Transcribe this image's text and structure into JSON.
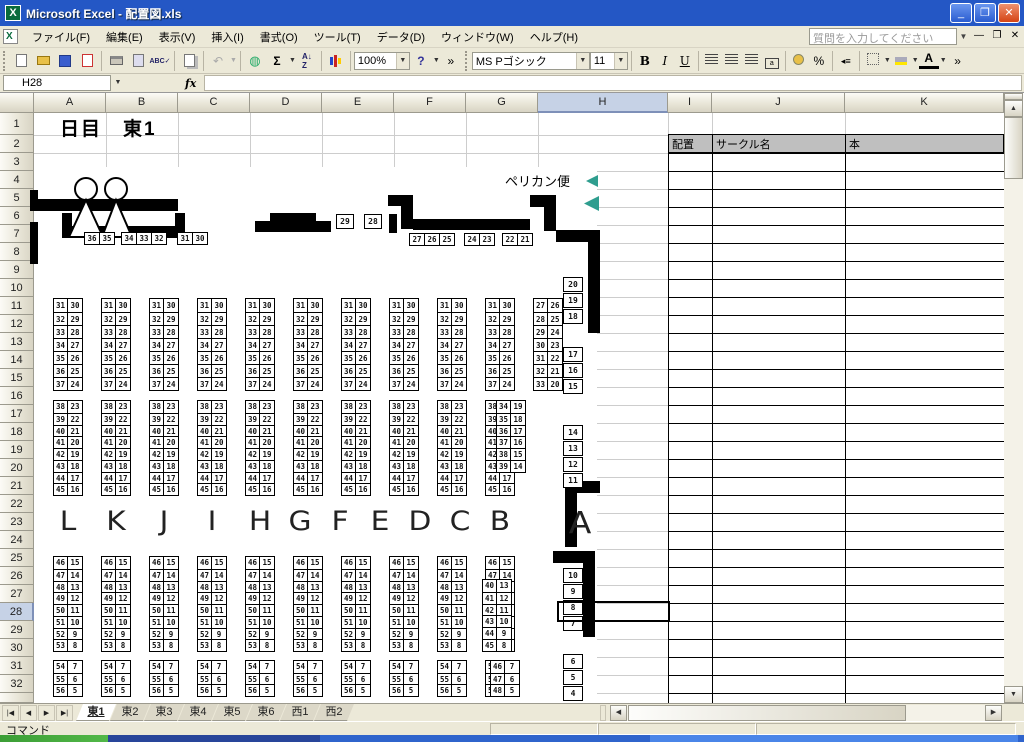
{
  "window": {
    "title": "Microsoft Excel - 配置図.xls"
  },
  "menu": {
    "items": [
      "ファイル(F)",
      "編集(E)",
      "表示(V)",
      "挿入(I)",
      "書式(O)",
      "ツール(T)",
      "データ(D)",
      "ウィンドウ(W)",
      "ヘルプ(H)"
    ],
    "question_placeholder": "質問を入力してください"
  },
  "toolbar": {
    "zoom": "100%",
    "font_name": "MS Pゴシック",
    "font_size": "11",
    "bold": "B",
    "italic": "I",
    "underline": "U",
    "sum": "Σ",
    "sort": "A↓",
    "spelling": "ABC",
    "undo": "↶",
    "help": "?",
    "overflow": "»",
    "percent": "%",
    "font_color": "A"
  },
  "formula_bar": {
    "name_box": "H28",
    "fx_label": "fx",
    "formula": ""
  },
  "grid": {
    "column_labels": [
      "A",
      "B",
      "C",
      "D",
      "E",
      "F",
      "G",
      "H",
      "I",
      "J",
      "K"
    ],
    "row_count": 32,
    "selected_column": "H",
    "selected_row": 28,
    "selected_cell": "H28"
  },
  "sheet": {
    "title": "日目　東1",
    "delivery_label": "ペリカン便",
    "lookup_headers": [
      "配置",
      "サークル名",
      "本"
    ],
    "block_letters": [
      "L",
      "K",
      "J",
      "I",
      "H",
      "G",
      "F",
      "E",
      "D",
      "C",
      "B",
      "A"
    ],
    "wall_numbers": {
      "top_left_groups": [
        [
          "36",
          "35"
        ],
        [
          "34",
          "33",
          "32"
        ],
        [
          "31",
          "30"
        ]
      ],
      "island_boxes": [
        "29",
        "28"
      ],
      "top_right_groups": [
        [
          "27",
          "26",
          "25"
        ],
        [
          "24",
          "23"
        ],
        [
          "22",
          "21"
        ]
      ],
      "right_groups": [
        [
          "20",
          "19",
          "18"
        ],
        [
          "17",
          "16",
          "15"
        ],
        [
          "14",
          "13",
          "12",
          "11"
        ],
        [
          "10",
          "9",
          "8",
          "7"
        ],
        [
          "6",
          "5",
          "4"
        ]
      ]
    },
    "booth_bands": [
      {
        "rows": [
          [
            "31",
            "30"
          ],
          [
            "32",
            "29"
          ],
          [
            "33",
            "28"
          ],
          [
            "34",
            "27"
          ],
          [
            "35",
            "26"
          ],
          [
            "36",
            "25"
          ],
          [
            "37",
            "24"
          ]
        ],
        "special_rows": [
          [
            "27",
            "26"
          ],
          [
            "28",
            "25"
          ],
          [
            "29",
            "24"
          ],
          [
            "30",
            "23"
          ],
          [
            "31",
            "22"
          ],
          [
            "32",
            "21"
          ],
          [
            "33",
            "20"
          ]
        ]
      },
      {
        "rows": [
          [
            "38",
            "23"
          ],
          [
            "39",
            "22"
          ],
          [
            "40",
            "21"
          ],
          [
            "41",
            "20"
          ],
          [
            "42",
            "19"
          ],
          [
            "43",
            "18"
          ],
          [
            "44",
            "17"
          ],
          [
            "45",
            "16"
          ]
        ],
        "special_rows": [
          [
            "34",
            "19"
          ],
          [
            "35",
            "18"
          ],
          [
            "36",
            "17"
          ],
          [
            "37",
            "16"
          ],
          [
            "38",
            "15"
          ],
          [
            "39",
            "14"
          ]
        ]
      },
      {
        "rows": [
          [
            "46",
            "15"
          ],
          [
            "47",
            "14"
          ],
          [
            "48",
            "13"
          ],
          [
            "49",
            "12"
          ],
          [
            "50",
            "11"
          ],
          [
            "51",
            "10"
          ],
          [
            "52",
            "9"
          ],
          [
            "53",
            "8"
          ]
        ],
        "special_rows": [
          [
            "40",
            "13"
          ],
          [
            "41",
            "12"
          ],
          [
            "42",
            "11"
          ],
          [
            "43",
            "10"
          ],
          [
            "44",
            "9"
          ],
          [
            "45",
            "8"
          ]
        ]
      },
      {
        "rows": [
          [
            "54",
            "7"
          ],
          [
            "55",
            "6"
          ],
          [
            "56",
            "5"
          ]
        ],
        "special_rows": [
          [
            "46",
            "7"
          ],
          [
            "47",
            "6"
          ],
          [
            "48",
            "5"
          ]
        ]
      }
    ]
  },
  "tabs": {
    "items": [
      "東1",
      "東2",
      "東3",
      "東4",
      "東5",
      "東6",
      "西1",
      "西2"
    ],
    "active": "東1"
  },
  "status": {
    "text": "コマンド"
  },
  "colors": {
    "titlebar_blue": "#2457c5",
    "chrome_beige": "#ece9d8",
    "header_selected": "#c6d2e6",
    "gridline": "#cdcdcd",
    "wall_black": "#000000",
    "marker_teal": "#2f9e8f",
    "lookup_header_gray": "#bfbfbf",
    "taskbar_green": "#3c9e36",
    "taskbar_blue": "#2f64cc"
  }
}
